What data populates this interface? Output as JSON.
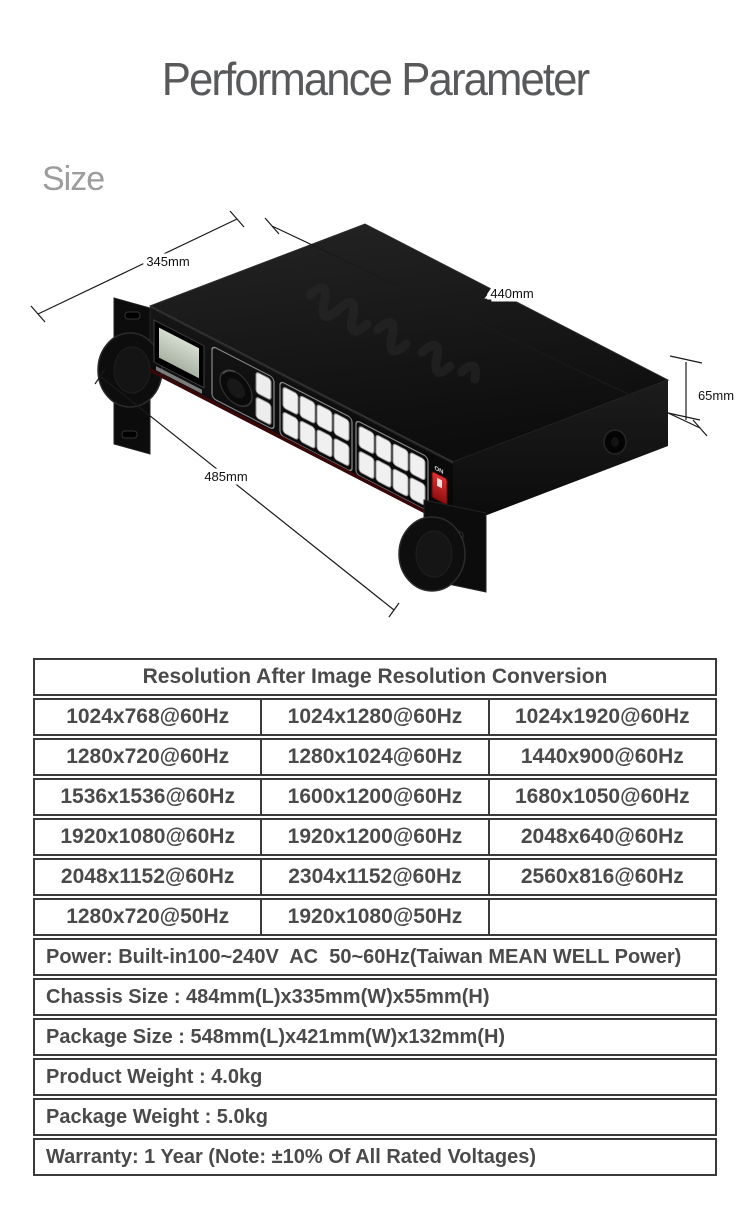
{
  "page": {
    "title": "Performance Parameter",
    "section_label": "Size"
  },
  "device": {
    "dim_depth": "345mm",
    "dim_width": "440mm",
    "dim_height": "65mm",
    "dim_front": "485mm",
    "power_switch_label": "ON"
  },
  "table": {
    "header": "Resolution After Image Resolution Conversion",
    "resolution_rows": [
      [
        "1024x768@60Hz",
        "1024x1280@60Hz",
        "1024x1920@60Hz"
      ],
      [
        "1280x720@60Hz",
        "1280x1024@60Hz",
        "1440x900@60Hz"
      ],
      [
        "1536x1536@60Hz",
        "1600x1200@60Hz",
        "1680x1050@60Hz"
      ],
      [
        "1920x1080@60Hz",
        "1920x1200@60Hz",
        "2048x640@60Hz"
      ],
      [
        "2048x1152@60Hz",
        "2304x1152@60Hz",
        "2560x816@60Hz"
      ],
      [
        "1280x720@50Hz",
        "1920x1080@50Hz",
        ""
      ]
    ],
    "spec_rows": [
      "Power: Built-in100~240V  AC  50~60Hz(Taiwan MEAN WELL Power)",
      "Chassis Size : 484mm(L)x335mm(W)x55mm(H)",
      "Package Size : 548mm(L)x421mm(W)x132mm(H)",
      "Product Weight : 4.0kg",
      "Package Weight : 5.0kg",
      "Warranty: 1 Year (Note: ±10% Of All Rated Voltages)"
    ]
  },
  "colors": {
    "table_border": "#3a3a3a",
    "table_text": "#4a4a4a",
    "title_text": "#58595b",
    "section_text": "#9c9c9c",
    "switch_red": "#c41e1e",
    "lcd_green": "#c7cfc3"
  }
}
